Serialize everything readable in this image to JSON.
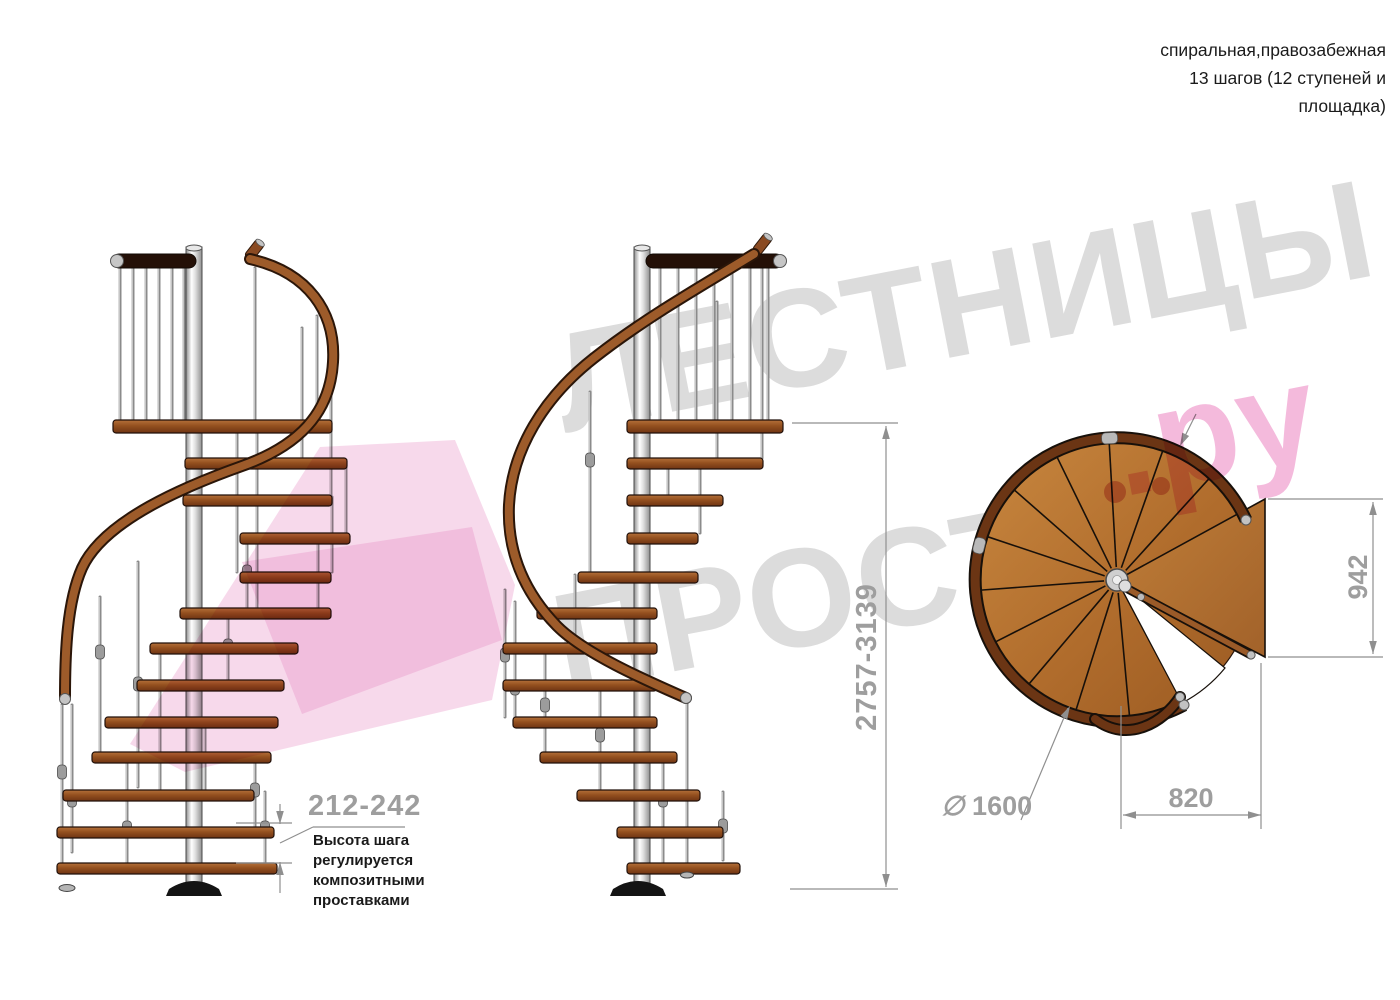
{
  "header": {
    "title": "спиральная,правозабежная\n13 шагов (12 ступеней и\nплощадка)"
  },
  "watermark": {
    "line1": "ЛЕСТНИЦЫ",
    "line2": "ПРОСТО",
    "line2_suffix": ".ру",
    "gray_color": "#dcdcdc",
    "pink_color": "#f2a9d4"
  },
  "dimensions": {
    "step_height": {
      "value": "212-242",
      "note": "Высота шага\nрегулируется\nкомпозитными\nпроставками"
    },
    "total_height": {
      "value": "2757-3139"
    },
    "landing_side": {
      "value": "942"
    },
    "landing_width": {
      "value": "820"
    },
    "diameter": {
      "symbol": "∅",
      "value": "1600"
    }
  },
  "colors": {
    "wood": "#9d5b2a",
    "wood_dark": "#6b3514",
    "metal": "#c9c9c9",
    "dim_line": "#8f8f8f",
    "dim_text": "#9e9e9e",
    "text": "#1b1b1b"
  }
}
